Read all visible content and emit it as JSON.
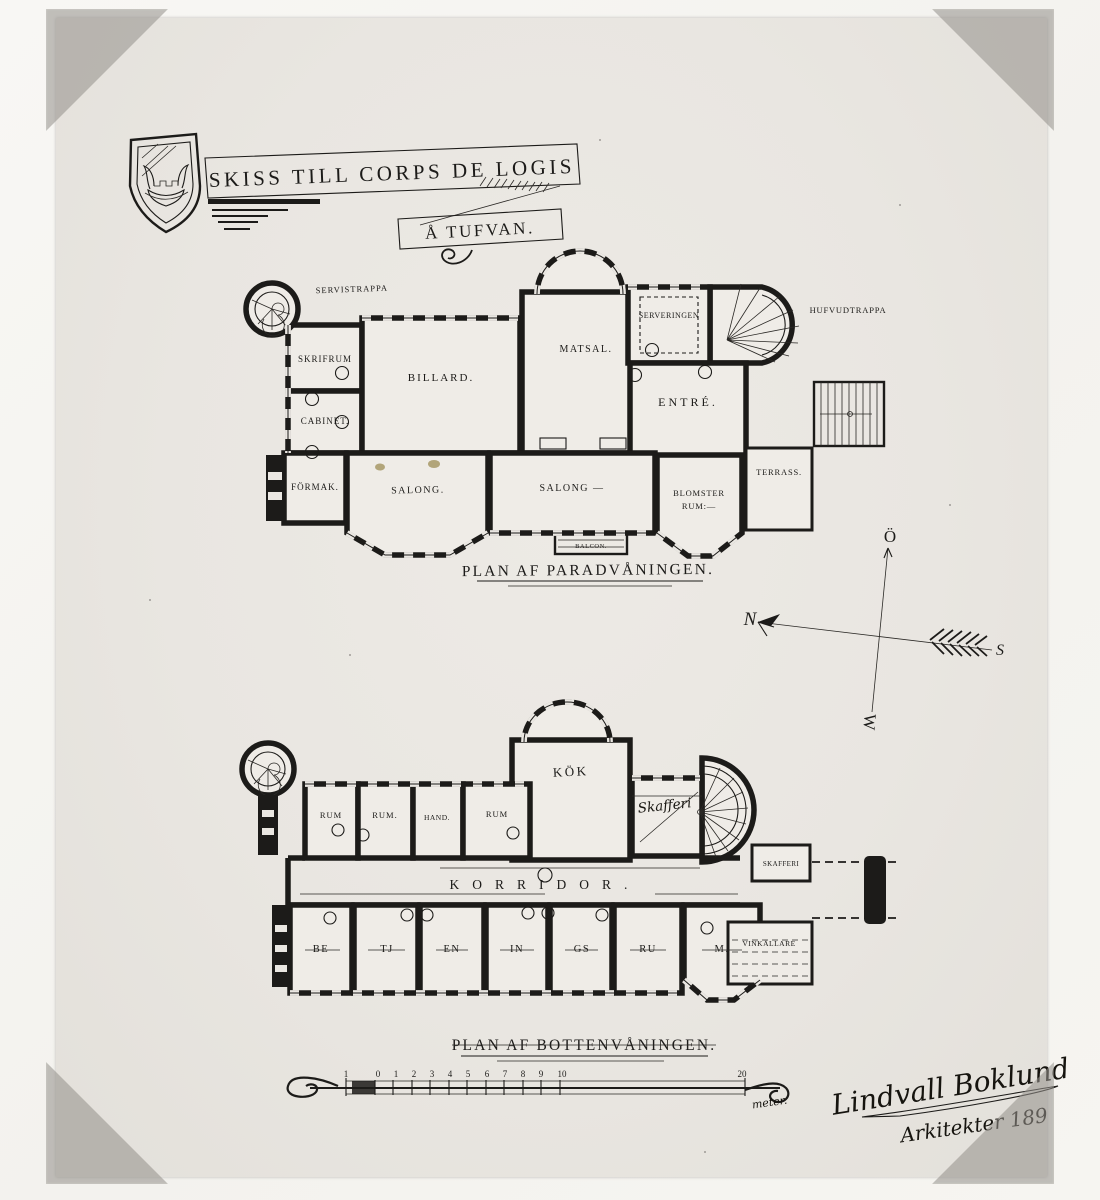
{
  "photo": {
    "title": "SKISS TILL CORPS DE LOGIS",
    "subtitle": "Å TUFVAN.",
    "upper_plan": {
      "caption": "PLAN AF PARADVÅNINGEN.",
      "rooms": {
        "servistrappa": "SERVISTRAPPA",
        "skrifrum": "SKRIFRUM",
        "cabinet": "CABINET.",
        "formak": "FÖRMAK.",
        "billard": "BILLARD.",
        "salong_left": "SALONG.",
        "salong_right": "SALONG —",
        "matsal": "MATSAL.",
        "serveringen": "SERVERINGEN",
        "entre": "ENTRÉ.",
        "blomster_line1": "BLOMSTER",
        "blomster_line2": "RUM:—",
        "terrass": "TERRASS.",
        "hufvudtrappa": "HUFVUDTRAPPA",
        "balcon": "BALCON."
      }
    },
    "compass": {
      "north": "N",
      "south": "S",
      "east": "Ö",
      "west": "W"
    },
    "lower_plan": {
      "caption": "PLAN AF BOTTENVÅNINGEN.",
      "rooms": {
        "kok": "KÖK",
        "skafferi_hand": "Skafferi",
        "rum1": "RUM",
        "rum2": "RUM.",
        "hand": "HAND.",
        "rum3": "RUM",
        "korridor": "KORRIDOR.",
        "skafferi_small": "SKAFFERI",
        "vinkallare": "VINKÄLLARE",
        "betjeningsrum": [
          "BE",
          "TJ",
          "EN",
          "IN",
          "GS",
          "RU",
          "M."
        ]
      }
    },
    "scale_bar": {
      "numbers": [
        "1",
        "0",
        "1",
        "2",
        "3",
        "4",
        "5",
        "6",
        "7",
        "8",
        "9",
        "10",
        "20"
      ],
      "unit": "meter."
    },
    "signature": {
      "line1": "Lindvall Boklund",
      "line2": "Arkitekter 189"
    }
  }
}
